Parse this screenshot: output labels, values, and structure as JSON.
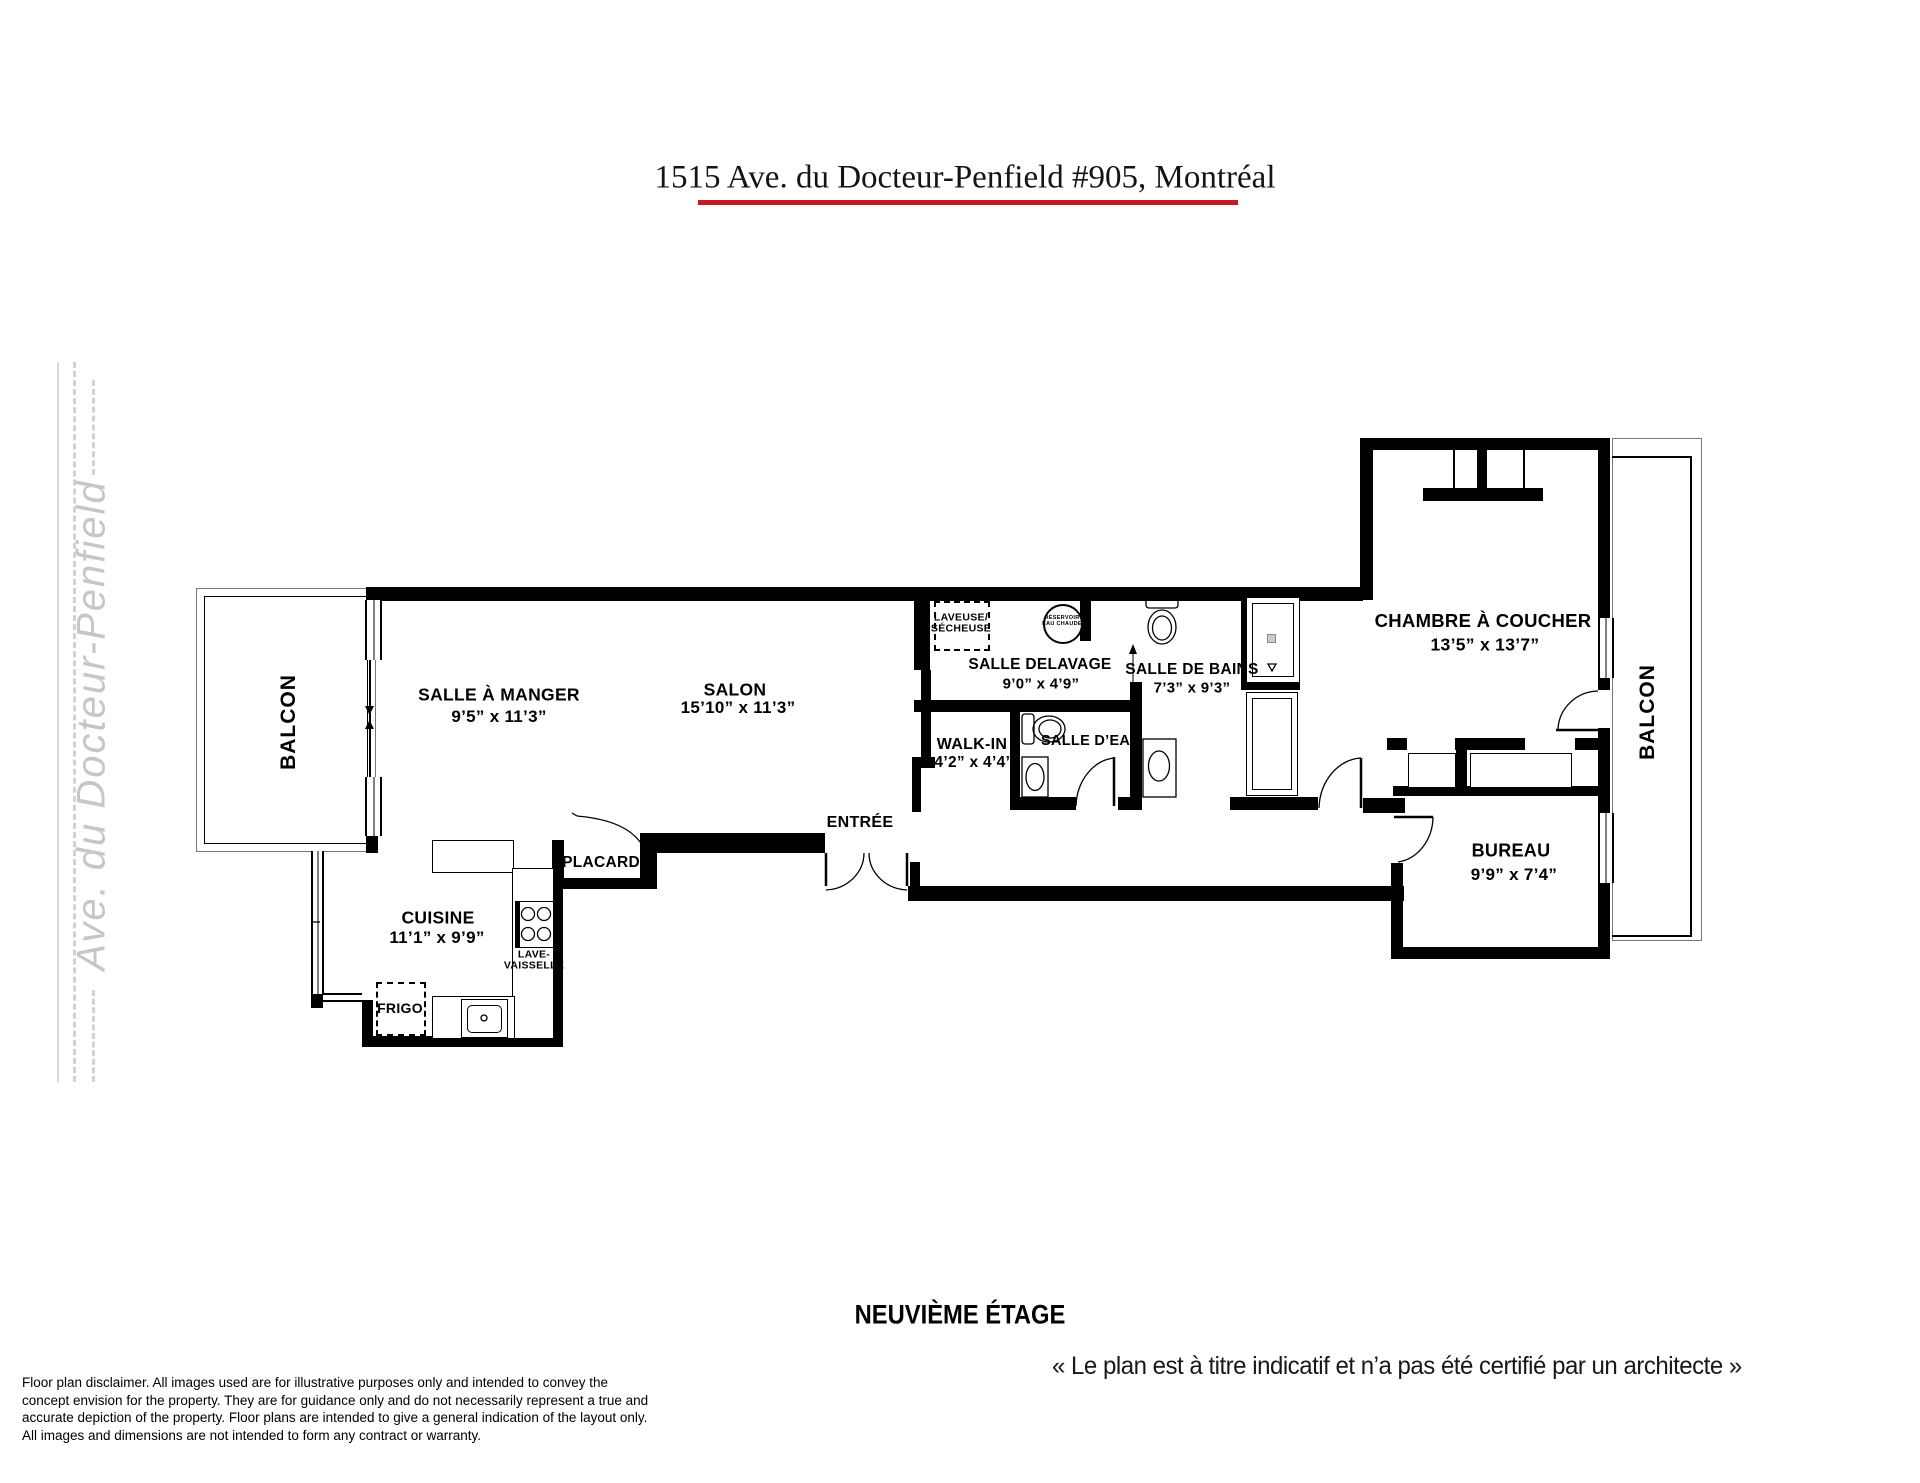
{
  "title": {
    "text": "1515 Ave. du Docteur-Penfield #905, Montréal",
    "underline_color": "#c41a22"
  },
  "street": {
    "label": "Ave. du Docteur-Penfield"
  },
  "floor_label": "NEUVIÈME ÉTAGE",
  "quote": "« Le plan est à titre indicatif et n’a pas été certifié par un architecte »",
  "disclaimer": {
    "lines": [
      "Floor plan disclaimer. All images used are for illustrative purposes only and intended to convey the",
      "concept envision for the property. They are for guidance only and do not necessarily represent a true and",
      "accurate depiction of the property. Floor plans are intended to give a general indication of the layout only.",
      "All images and dimensions are not intended to form any contract or warranty."
    ]
  },
  "rooms": {
    "salle_a_manger": {
      "name": "SALLE À MANGER",
      "dims": "9’5” x 11’3”"
    },
    "salon": {
      "name": "SALON",
      "dims": "15’10” x 11’3”"
    },
    "cuisine": {
      "name": "CUISINE",
      "dims": "11’1” x 9’9”"
    },
    "placard": {
      "name": "PLACARD"
    },
    "entree": {
      "name": "ENTRÉE"
    },
    "walk_in": {
      "name": "WALK-IN",
      "dims": "4’2” x 4’4”"
    },
    "salle_delavage": {
      "name": "SALLE DELAVAGE",
      "dims": "9’0” x 4’9”"
    },
    "salle_d_eau": {
      "name": "SALLE D’EAU"
    },
    "salle_de_bains": {
      "name": "SALLE DE BAINS",
      "dims": "7’3” x 9’3”"
    },
    "chambre": {
      "name": "CHAMBRE À COUCHER",
      "dims": "13’5” x 13’7”"
    },
    "bureau": {
      "name": "BUREAU",
      "dims": "9’9” x 7’4”"
    },
    "balcon_left": {
      "name": "BALCON"
    },
    "balcon_right": {
      "name": "BALCON"
    }
  },
  "appliances": {
    "laveuse_line1": "LAVEUSE/",
    "laveuse_line2": "SÉCHEUSE",
    "lave_vaisselle_line1": "LAVE-",
    "lave_vaisselle_line2": "VAISSELLE",
    "frigo": "FRIGO",
    "reservoir_line1": "RÉSERVOIR",
    "reservoir_line2": "EAU CHAUDE"
  }
}
